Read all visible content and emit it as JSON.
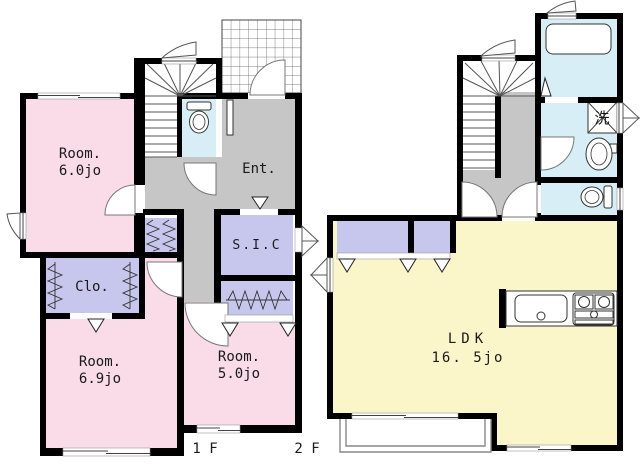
{
  "title": "floor-plan",
  "colors": {
    "room_pink": "#F9DCE8",
    "closet_purple": "#C7C7EE",
    "hall_gray": "#C6C6C6",
    "wet_blue": "#D7EEF7",
    "ldk_yellow": "#FAF6CA",
    "wall_black": "#000000",
    "white": "#FFFFFF"
  },
  "floor_1f": {
    "floor_label": "1 F",
    "room_a_name": "Room.",
    "room_a_area": "6.0jo",
    "entrance_label": "Ent.",
    "sic_label": "S.I.C",
    "closet_label": "Clo.",
    "room_b_name": "Room.",
    "room_b_area": "6.9jo",
    "room_c_name": "Room.",
    "room_c_area": "5.0jo"
  },
  "floor_2f": {
    "floor_label": "2 F",
    "ldk_name": "LDK",
    "ldk_area": "16. 5jo",
    "laundry_label": "洗"
  }
}
